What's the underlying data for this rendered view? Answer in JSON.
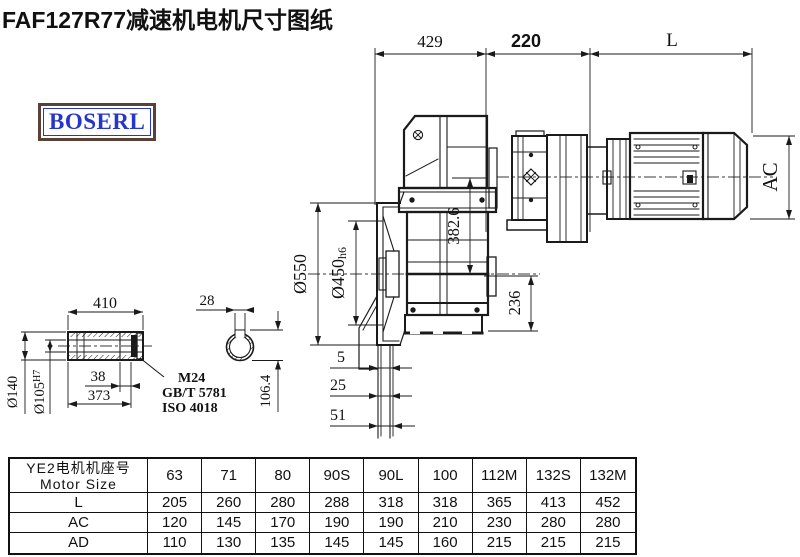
{
  "title": "FAF127R77减速机电机尺寸图纸",
  "logo": {
    "text": "BOSERL"
  },
  "colors": {
    "line": "#1a1a1a",
    "logo_text": "#2636c8",
    "logo_border": "#5a4036",
    "background": "#ffffff"
  },
  "drawing": {
    "dims": {
      "d429": "429",
      "d220": "220",
      "dL": "L",
      "dAC": "AC",
      "d382": "382.6",
      "d236": "236",
      "d550": "Ø550",
      "d450": "Ø450",
      "d450tol": "h6",
      "d5": "5",
      "d25": "25",
      "d51": "51",
      "d410": "410",
      "d140": "Ø140",
      "d105": "Ø105",
      "d105tol": "H7",
      "d38": "38",
      "d373": "373",
      "d28": "28",
      "d106": "106.4",
      "thread": "M24",
      "std1": "GB/T 5781",
      "std2": "ISO 4018"
    }
  },
  "table": {
    "header_cn": "YE2电机机座号",
    "header_en": "Motor Size",
    "columns": [
      "63",
      "71",
      "80",
      "90S",
      "90L",
      "100",
      "112M",
      "132S",
      "132M"
    ],
    "rows": [
      {
        "label": "L",
        "values": [
          "205",
          "260",
          "280",
          "288",
          "318",
          "318",
          "365",
          "413",
          "452"
        ]
      },
      {
        "label": "AC",
        "values": [
          "120",
          "145",
          "170",
          "190",
          "190",
          "210",
          "230",
          "280",
          "280"
        ]
      },
      {
        "label": "AD",
        "values": [
          "110",
          "130",
          "135",
          "145",
          "145",
          "160",
          "215",
          "215",
          "215"
        ]
      }
    ]
  }
}
